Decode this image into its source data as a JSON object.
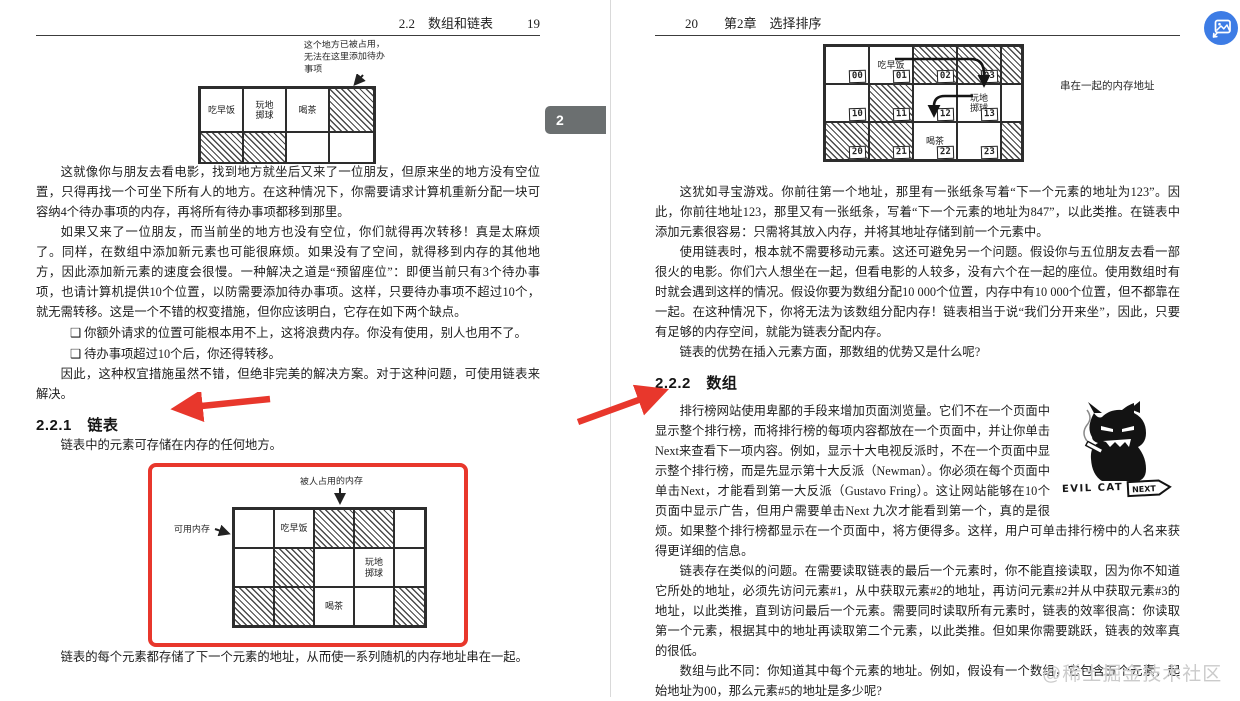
{
  "left_page": {
    "header_title": "2.2　数组和链表",
    "header_page": "19",
    "fig1": {
      "note_l1": "这个地方已被占用，",
      "note_l2": "无法在这里添加待办",
      "note_l3": "事项",
      "cells": {
        "breakfast": "吃早饭",
        "bocce": "玩地掷球",
        "tea": "喝茶"
      }
    },
    "p1": "这就像你与朋友去看电影，找到地方就坐后又来了一位朋友，但原来坐的地方没有空位置，只得再找一个可坐下所有人的地方。在这种情况下，你需要请求计算机重新分配一块可容纳4个待办事项的内存，再将所有待办事项都移到那里。",
    "p2": "如果又来了一位朋友，而当前坐的地方也没有空位，你们就得再次转移！真是太麻烦了。同样，在数组中添加新元素也可能很麻烦。如果没有了空间，就得移到内存的其他地方，因此添加新元素的速度会很慢。一种解决之道是“预留座位”：即便当前只有3个待办事项，也请计算机提供10个位置，以防需要添加待办事项。这样，只要待办事项不超过10个，就无需转移。这是一个不错的权变措施，但你应该明白，它存在如下两个缺点。",
    "bullet1": "❑ 你额外请求的位置可能根本用不上，这将浪费内存。你没有使用，别人也用不了。",
    "bullet2": "❑ 待办事项超过10个后，你还得转移。",
    "p3": "因此，这种权宜措施虽然不错，但绝非完美的解决方案。对于这种问题，可使用链表来解决。",
    "h221": "2.2.1　链表",
    "p4": "链表中的元素可存储在内存的任何地方。",
    "fig2": {
      "note_top": "被人占用的内存",
      "note_left": "可用内存",
      "cells": {
        "breakfast": "吃早饭",
        "bocce": "玩地掷球",
        "tea": "喝茶"
      }
    },
    "caption": "链表的每个元素都存储了下一个元素的地址，从而使一系列随机的内存地址串在一起。"
  },
  "right_page": {
    "header_page": "20",
    "header_title": "第2章　选择排序",
    "fig": {
      "side_note": "串在一起的内存地址",
      "cells": [
        {
          "addr": "00",
          "label": ""
        },
        {
          "addr": "01",
          "label": "吃早饭"
        },
        {
          "addr": "02",
          "label": ""
        },
        {
          "addr": "03",
          "label": ""
        },
        {
          "addr": "10",
          "label": ""
        },
        {
          "addr": "11",
          "label": ""
        },
        {
          "addr": "12",
          "label": ""
        },
        {
          "addr": "13",
          "label": "玩地掷球"
        },
        {
          "addr": "20",
          "label": ""
        },
        {
          "addr": "21",
          "label": ""
        },
        {
          "addr": "22",
          "label": "喝茶"
        },
        {
          "addr": "23",
          "label": ""
        }
      ]
    },
    "p1": "这犹如寻宝游戏。你前往第一个地址，那里有一张纸条写着“下一个元素的地址为123”。因此，你前往地址123，那里又有一张纸条，写着“下一个元素的地址为847”，以此类推。在链表中添加元素很容易：只需将其放入内存，并将其地址存储到前一个元素中。",
    "p2": "使用链表时，根本就不需要移动元素。这还可避免另一个问题。假设你与五位朋友去看一部很火的电影。你们六人想坐在一起，但看电影的人较多，没有六个在一起的座位。使用数组时有时就会遇到这样的情况。假设你要为数组分配10 000个位置，内存中有10 000个位置，但不都靠在一起。在这种情况下，你将无法为该数组分配内存！链表相当于说“我们分开来坐”，因此，只要有足够的内存空间，就能为链表分配内存。",
    "p3": "链表的优势在插入元素方面，那数组的优势又是什么呢?",
    "h222": "2.2.2　数组",
    "p4": "排行榜网站使用卑鄙的手段来增加页面浏览量。它们不在一个页面中显示整个排行榜，而将排行榜的每项内容都放在一个页面中，并让你单击Next来查看下一项内容。例如，显示十大电视反派时，不在一个页面中显示整个排行榜，而是先显示第十大反派（Newman）。你必须在每个页面中单击Next，才能看到第一大反派（Gustavo Fring）。这让网站能够在10个页面中显示广告，但用户需要单击Next 九次才能看到第一个，真的是很烦。如果整个排行榜都显示在一个页面中，将方便得多。这样，用户可单击排行榜中的人名来获得更详细的信息。",
    "cat_label": "EVIL CAT",
    "next_label": "NEXT",
    "p5": "链表存在类似的问题。在需要读取链表的最后一个元素时，你不能直接读取，因为你不知道它所处的地址，必须先访问元素#1，从中获取元素#2的地址，再访问元素#2并从中获取元素#3的地址，以此类推，直到访问最后一个元素。需要同时读取所有元素时，链表的效率很高：你读取第一个元素，根据其中的地址再读取第二个元素，以此类推。但如果你需要跳跃，链表的效率真的很低。",
    "p6": "数组与此不同：你知道其中每个元素的地址。例如，假设有一个数组，它包含五个元素，起始地址为00，那么元素#5的地址是多少呢?"
  },
  "overlay": {
    "chapter_tab": "2",
    "watermark": "@稀土掘金技术社区"
  },
  "colors": {
    "accent_red": "#e8372c",
    "tab_gray": "#6b6f70",
    "fab_blue": "#3d7ce5",
    "watermark_gray": "#cbcbcb"
  }
}
